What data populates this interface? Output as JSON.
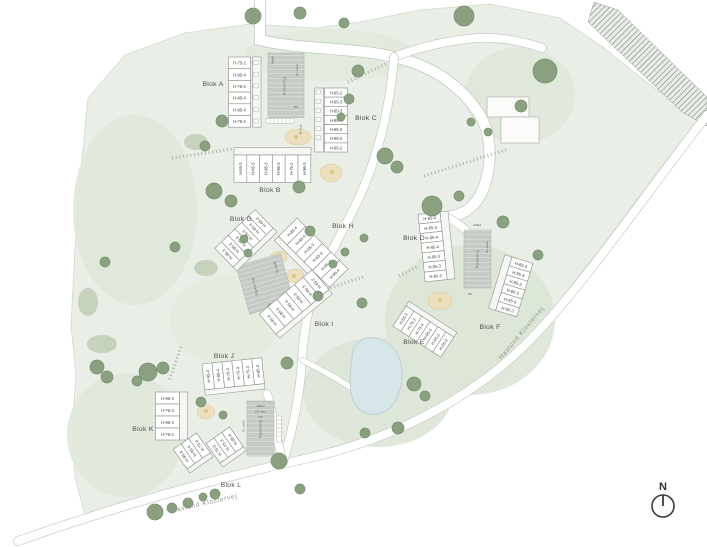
{
  "plan_title": "Site plan",
  "streets": {
    "name": "Haslund Klostervej"
  },
  "compass": {
    "label": "N"
  },
  "site_labels": {
    "parking": "Parkering",
    "waste": "Affald",
    "electrical": "EL-tavle",
    "hc": "HC",
    "hc_bus": "HC-bus"
  },
  "blocks": [
    {
      "name": "Blok A",
      "units": [
        "H-75-2",
        "H-95-4",
        "H-75-2",
        "H-85-4",
        "H-95-4",
        "H-75-2"
      ]
    },
    {
      "name": "Blok B",
      "units": [
        "H-65-3",
        "H-65-3",
        "H-95-3",
        "H-95-3",
        "H-75-2",
        "H-95-3"
      ]
    },
    {
      "name": "Blok C",
      "units": [
        "H-65-2",
        "H-65-3",
        "H-65-3",
        "H-95-4",
        "H-65-2",
        "H-65-2",
        "H-65-2"
      ]
    },
    {
      "name": "Blok D",
      "units": [
        "H-85-4",
        "H-85-4",
        "H-85-4",
        "H-85-4",
        "H-65-3",
        "H-65-3",
        "H-65-2"
      ]
    },
    {
      "name": "Blok E",
      "units": [
        "H-65-2",
        "H-75-2",
        "H-75-4",
        "H-95-3",
        "H-95-3",
        "H-65-2"
      ]
    },
    {
      "name": "Blok F",
      "units": [
        "H-85-3",
        "H-85-3",
        "H-85-3",
        "H-85-3",
        "H-65-3",
        "H-65-2"
      ]
    },
    {
      "name": "Blok G",
      "units": [
        "H-65-2",
        "H-65-3",
        "H-75-3",
        "H-75-3",
        "H-95-3",
        "H-95-3"
      ]
    },
    {
      "name": "Blok H",
      "units": [
        "H-85-4",
        "H-85-4",
        "H-65-3",
        "H-65-3",
        "H-95-4",
        "H-95-4"
      ]
    },
    {
      "name": "Blok I",
      "units": [
        "H-65-2",
        "H-65-3",
        "H-65-3",
        "H-95-4",
        "H-95-4",
        "H-95-4"
      ]
    },
    {
      "name": "Blok J",
      "units": [
        "H-95-4",
        "H-95-4",
        "H-75-3",
        "H-75-3",
        "H-75-3",
        "H-85-3"
      ]
    },
    {
      "name": "Blok K",
      "units": [
        "H-95-4",
        "H-75-3",
        "H-95-4",
        "H-75-2"
      ]
    },
    {
      "name": "Blok L",
      "units": [
        "H-95-4",
        "H-95-4",
        "H-75-4",
        "H-75-3",
        "H-75-3",
        "H-85-4"
      ]
    }
  ],
  "colors": {
    "site_green": "#e9eee6",
    "lawn_green": "#dfe8da",
    "tree_green": "#8aa081",
    "pond_blue": "#d6e6e9",
    "parking_gray": "#c7cbc6",
    "sand_tan": "#ecdfbd",
    "road_edge": "#c6ccc4",
    "building_white": "#ffffff",
    "outline_gray": "#8f968e"
  }
}
